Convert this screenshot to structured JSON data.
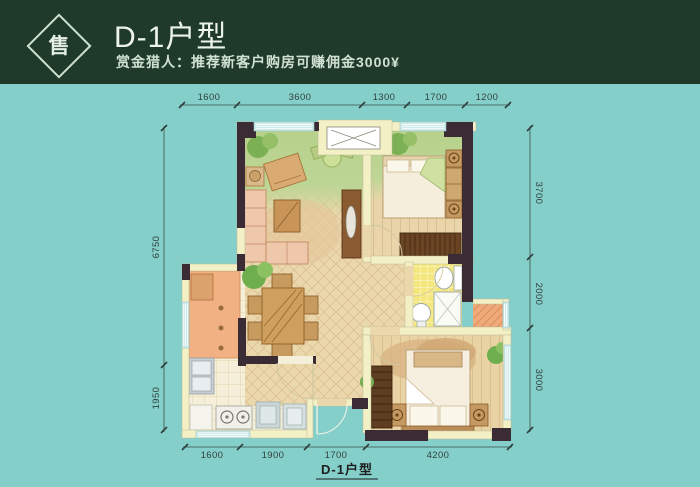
{
  "header": {
    "badge_label": "售",
    "title": "D-1户型",
    "subtitle": "赏金猎人：推荐新客户购房可赚佣金3000¥"
  },
  "floor_plan": {
    "caption": "D-1户型",
    "dims": {
      "top": [
        "1600",
        "3600",
        "1300",
        "1700",
        "1200"
      ],
      "bottom": [
        "1600",
        "1900",
        "1700",
        "4200"
      ],
      "left": [
        "6750",
        "1950"
      ],
      "right": [
        "3700",
        "2000",
        "3000"
      ]
    }
  },
  "colors": {
    "background": "#84cfc9",
    "header_bg": "#1f3a2b",
    "wall_dark": "#3a2b35",
    "wall_light": "#f4f0c6",
    "living_green": "#b7d28c",
    "wood_floor": "#ead7ab",
    "bath_yellow": "#f3e77e",
    "balcony_orange": "#efaa7c",
    "window_blue": "#cfeaea"
  }
}
